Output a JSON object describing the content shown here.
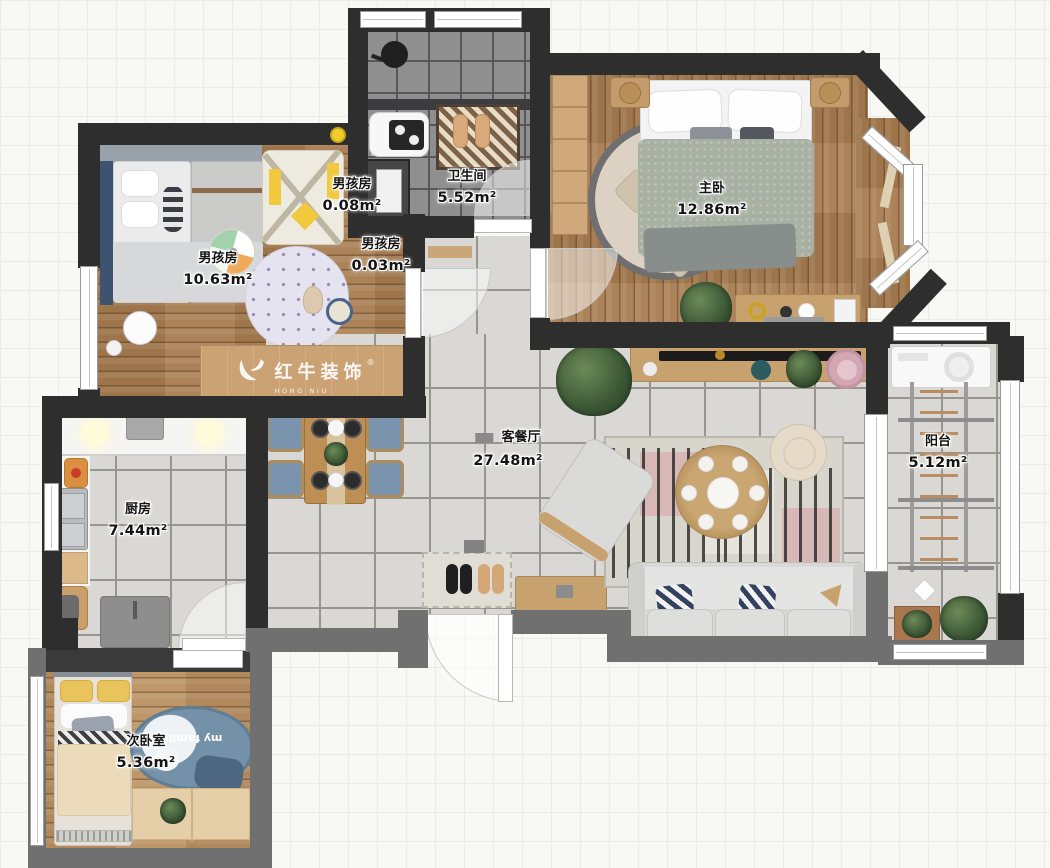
{
  "watermark": {
    "reg": "®",
    "brand": "红牛装饰",
    "sub": "HONG NIU DECORATION"
  },
  "rooms": [
    {
      "id": "boys-closet-top",
      "name": "男孩房",
      "area": "0.08m²"
    },
    {
      "id": "bathroom",
      "name": "卫生间",
      "area": "5.52m²"
    },
    {
      "id": "master-bedroom",
      "name": "主卧",
      "area": "12.86m²"
    },
    {
      "id": "boys-room",
      "name": "男孩房",
      "area": "10.63m²"
    },
    {
      "id": "boys-closet-low",
      "name": "男孩房",
      "area": "0.03m²"
    },
    {
      "id": "living-dining",
      "name": "客餐厅",
      "area": "27.48m²"
    },
    {
      "id": "balcony",
      "name": "阳台",
      "area": "5.12m²"
    },
    {
      "id": "kitchen",
      "name": "厨房",
      "area": "7.44m²"
    },
    {
      "id": "second-bedroom",
      "name": "次卧室",
      "area": "5.36m²"
    }
  ],
  "decor": {
    "second_bedroom_rug_text": "my family"
  },
  "colors": {
    "wall_dark": "#2e2e2e",
    "wall_gray": "#707070",
    "wood": "#a87c50",
    "tile_light": "#d9d8d4",
    "tile_dark": "#8f8f90",
    "marker_yellow": "#f2cc2a",
    "rug_blue": "#7391a8"
  }
}
